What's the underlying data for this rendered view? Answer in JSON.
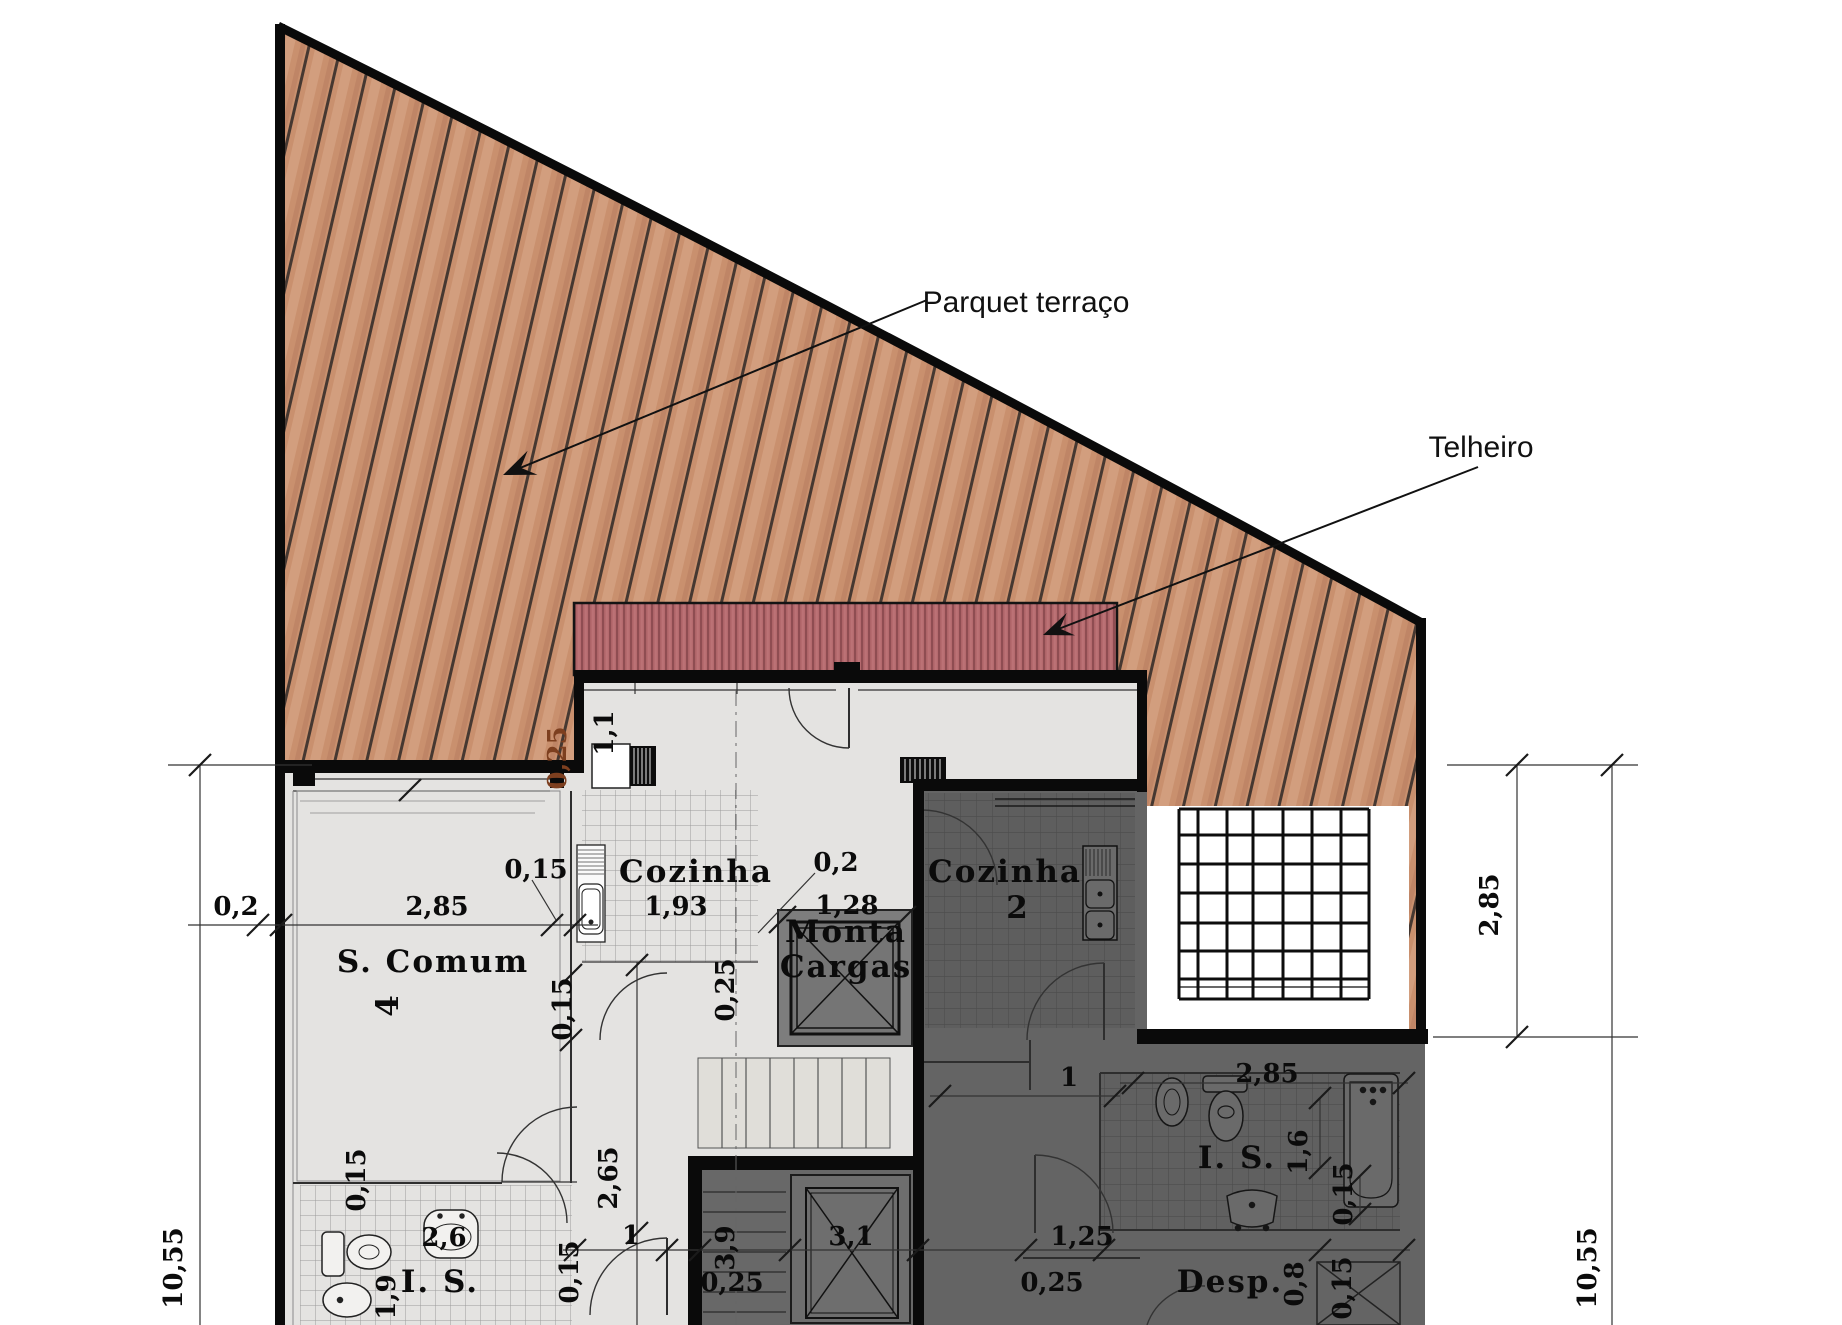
{
  "annotations": {
    "parquet_label": "Parquet terraço",
    "telheiro_label": "Telheiro"
  },
  "rooms": {
    "s_comum": "S. Comum",
    "s_comum_no": "4",
    "cozinha_left": "Cozinha",
    "cozinha_left_no": "1,93",
    "monta_line1": "Monta",
    "monta_line2": "Cargas",
    "cozinha_right": "Cozinha",
    "cozinha_right_no": "2",
    "is_left": "I. S.",
    "is_right": "I. S.",
    "desp": "Desp."
  },
  "dims": {
    "d1": "0,2",
    "d2": "2,85",
    "d3": "0,15",
    "d4": "1,1",
    "d5": "0,25",
    "d6": "0,2",
    "d7": "1,28",
    "d8": "0,25",
    "d9": "0,15",
    "d10": "2,65",
    "d11": "0,15",
    "d12": "2,6",
    "d13": "1,9",
    "d14": "1",
    "d15": "0,15",
    "d16": "3,9",
    "d17": "0,25",
    "d18": "3,1",
    "d19": "1",
    "d20": "2,85",
    "d21": "1,6",
    "d22": "0,15",
    "d23": "1,25",
    "d24": "0,25",
    "d25": "0,8",
    "d26": "0,15",
    "d27": "2,85",
    "d28": "10,55",
    "d29": "10,55",
    "d30": "1,7",
    "d31": "1,0"
  },
  "colors": {
    "wood_base": "#c9906e",
    "wood_light": "#d9a98a",
    "wood_dark": "#b67a5e",
    "plank_line": "#463831",
    "roof_red": "#b56a6e",
    "roof_stripe": "#8f4d52",
    "floor_light": "#e4e3e1",
    "floor_dark": "#646464",
    "wall_black": "#0a0a0a",
    "line_brown": "#7d3f1f"
  }
}
